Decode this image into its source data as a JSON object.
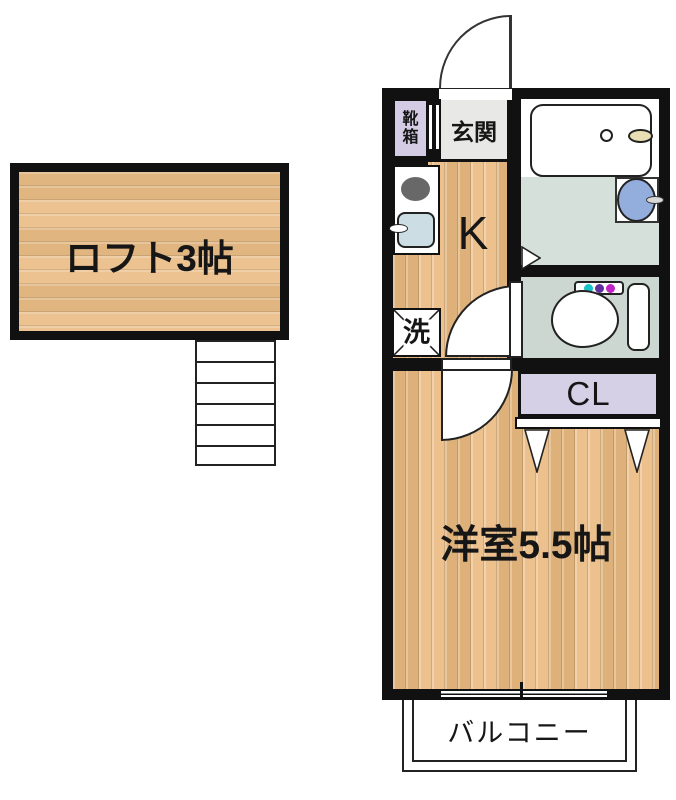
{
  "labels": {
    "loft": "ロフト3帖",
    "shoebox": "靴箱",
    "entrance": "玄関",
    "kitchen": "K",
    "washer": "洗",
    "closet": "CL",
    "western_room": "洋室5.5帖",
    "balcony": "バルコニー"
  },
  "colors": {
    "wall": "#111111",
    "wood_floor": "#eaba80",
    "loft_floor": "#e9bc85",
    "entrance_floor": "#e8e8e6",
    "bathroom_floor": "#d5e0da",
    "toilet_floor": "#ccd7d1",
    "closet_fill": "#d6d0e6",
    "shoebox_fill": "#d3cce4",
    "kitchen_sink_fill": "#ccdde4",
    "wash_basin_fill": "#93aedd",
    "bath_faucet_fill": "#eadfb4",
    "stove_burner_fill": "#686868",
    "toilet_button_colors": [
      "#17c3c9",
      "#5f2f9e",
      "#bf23c5"
    ]
  }
}
